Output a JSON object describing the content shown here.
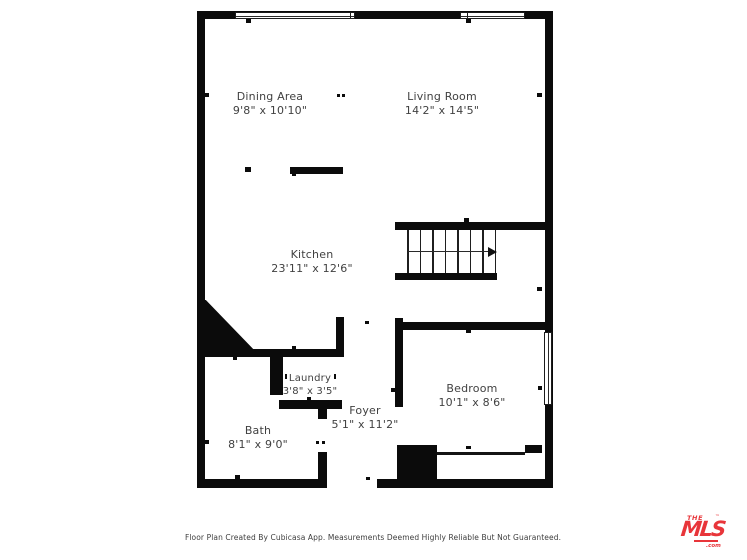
{
  "plan": {
    "wall_color": "#0b0b0b",
    "text_color": "#414141",
    "rooms": [
      {
        "name": "Dining Area",
        "dims": "9'8\" x 10'10\""
      },
      {
        "name": "Living Room",
        "dims": "14'2\" x 14'5\""
      },
      {
        "name": "Kitchen",
        "dims": "23'11\" x 12'6\""
      },
      {
        "name": "Laundry",
        "dims": "3'8\" x 3'5\""
      },
      {
        "name": "Foyer",
        "dims": "5'1\" x 11'2\""
      },
      {
        "name": "Bath",
        "dims": "8'1\" x 9'0\""
      },
      {
        "name": "Bedroom",
        "dims": "10'1\" x 8'6\""
      }
    ],
    "footer": "Floor Plan Created By Cubicasa App. Measurements Deemed Highly Reliable But Not Guaranteed."
  },
  "logo": {
    "line1": "THE",
    "line2": "MLS",
    "tm": "™",
    "com": ".com",
    "color": "#e8353a"
  }
}
